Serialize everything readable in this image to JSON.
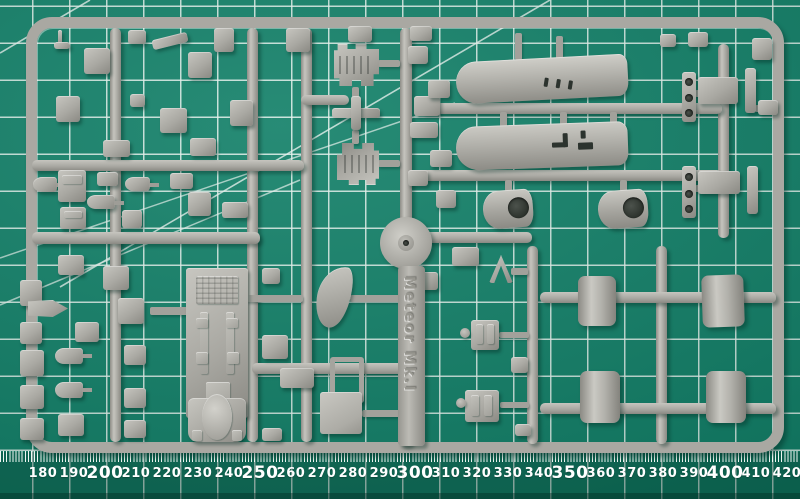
{
  "colors": {
    "mat_green": "#0f7e66",
    "mat_shade": "#0a5d4b",
    "grid_line": "#e6f2ed",
    "plastic": "#a9a8a2",
    "plastic_light": "#c7c6c0",
    "plastic_dark": "#8a8983",
    "ruler_text": "#ffffff"
  },
  "mat": {
    "ruler": {
      "labels": [
        "180",
        "190",
        "200",
        "210",
        "220",
        "230",
        "240",
        "250",
        "260",
        "270",
        "280",
        "290",
        "300",
        "310",
        "320",
        "330",
        "340",
        "350",
        "360",
        "370",
        "380",
        "390",
        "400",
        "410",
        "420"
      ]
    }
  },
  "sprue": {
    "label": "Meteor Mk.I"
  }
}
